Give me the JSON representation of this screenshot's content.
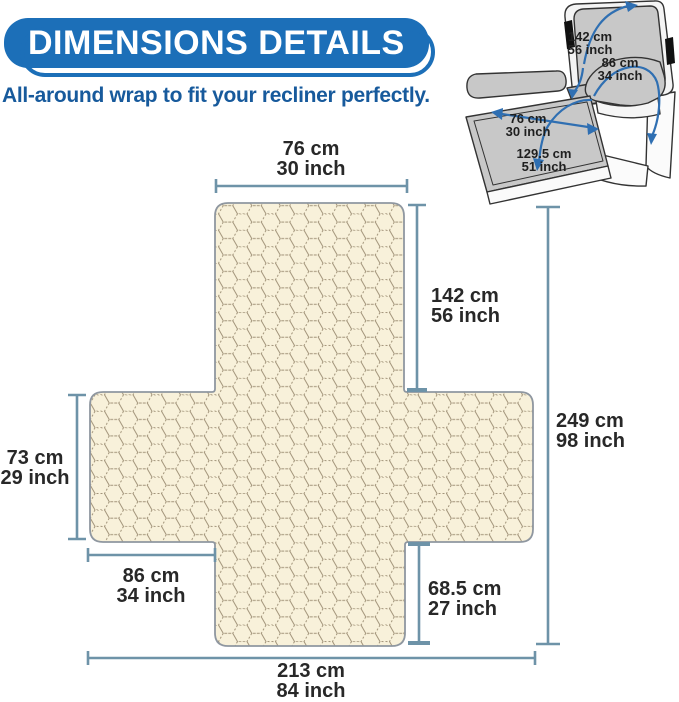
{
  "header": {
    "badge": "DIMENSIONS DETAILS",
    "subtitle": "All-around wrap to fit your recliner perfectly."
  },
  "colors": {
    "badge_blue": "#1c6fb8",
    "subtitle_blue": "#175a9c",
    "dimension_line": "#6e93a8",
    "label_text": "#282828",
    "cover_fill": "#f8f1da",
    "hex_pattern_stroke": "#a2947a",
    "cover_outline": "#8f97a0",
    "recliner_gray": "#c8c8c8",
    "arrow_blue": "#2f6fb2"
  },
  "recliner_labels": {
    "back_height": {
      "cm": "142 cm",
      "inch": "56 inch"
    },
    "arm_wrap": {
      "cm": "86 cm",
      "inch": "34 inch"
    },
    "footrest_width": {
      "cm": "76 cm",
      "inch": "30 inch"
    },
    "seat_length": {
      "cm": "129.5 cm",
      "inch": "51 inch"
    }
  },
  "cover_dimensions": {
    "top_width": {
      "cm": "76 cm",
      "inch": "30 inch"
    },
    "back_length": {
      "cm": "142 cm",
      "inch": "56 inch"
    },
    "total_length": {
      "cm": "249 cm",
      "inch": "98 inch"
    },
    "side_height": {
      "cm": "73 cm",
      "inch": "29 inch"
    },
    "armrest_width": {
      "cm": "86 cm",
      "inch": "34 inch"
    },
    "front_length": {
      "cm": "68.5 cm",
      "inch": "27 inch"
    },
    "total_width": {
      "cm": "213 cm",
      "inch": "84 inch"
    }
  }
}
